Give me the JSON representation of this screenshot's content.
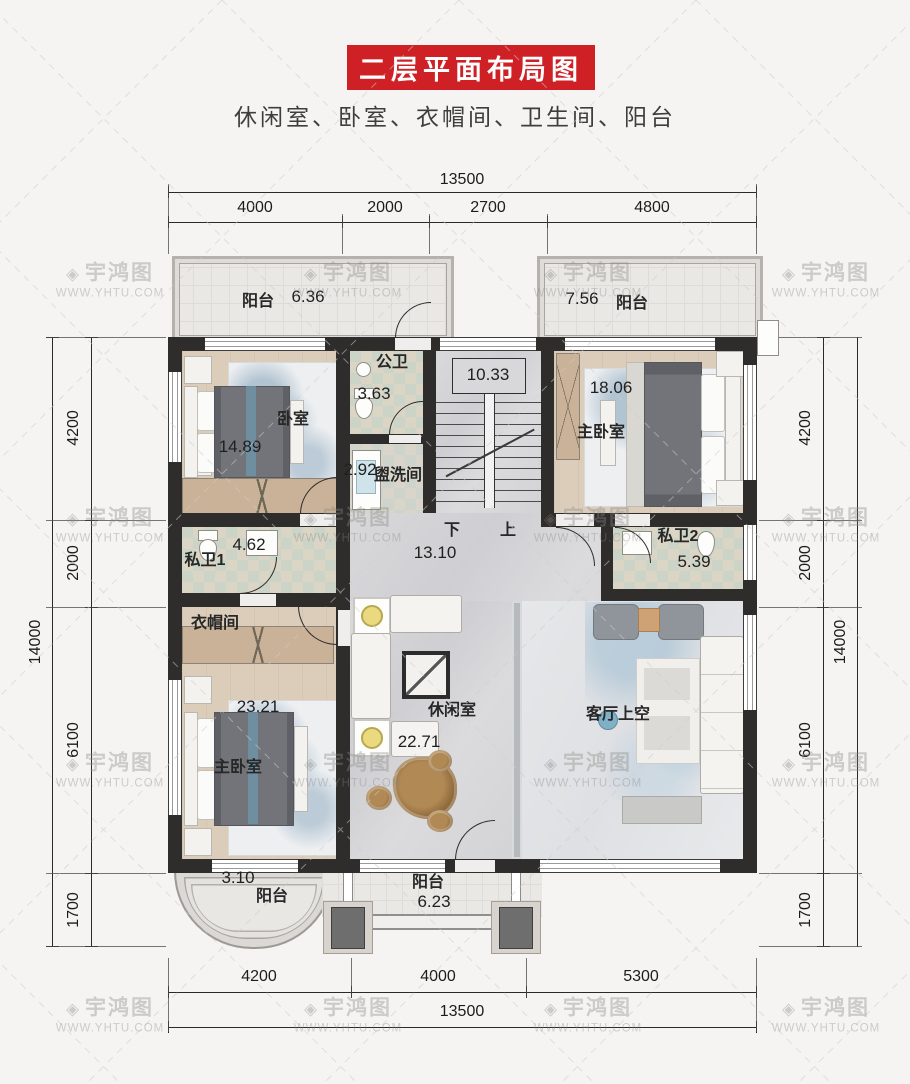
{
  "header": {
    "title": "二层平面布局图",
    "subtitle": "休闲室、卧室、衣帽间、卫生间、阳台",
    "banner_color": "#ce2025"
  },
  "watermark": {
    "logo": "◈",
    "brand": "宇鸿图",
    "url": "WWW.YHTU.COM"
  },
  "dimensions": {
    "top": {
      "total": "13500",
      "segments": [
        "4000",
        "2000",
        "2700",
        "4800"
      ]
    },
    "bottom": {
      "total": "13500",
      "segments": [
        "4200",
        "4000",
        "5300"
      ]
    },
    "left": {
      "total": "14000",
      "segments": [
        "4200",
        "2000",
        "6100",
        "1700"
      ]
    },
    "right": {
      "total": "14000",
      "segments": [
        "4200",
        "2000",
        "6100",
        "1700"
      ]
    }
  },
  "rooms": {
    "balcony_tl": {
      "name": "阳台",
      "area": "6.36"
    },
    "balcony_tr": {
      "name": "阳台",
      "area": "7.56"
    },
    "bedroom": {
      "name": "卧室",
      "area": "14.89"
    },
    "public_bath": {
      "name": "公卫",
      "area": "3.63"
    },
    "washroom": {
      "name": "盥洗间",
      "area": "2.92"
    },
    "stairs": {
      "area": "10.33",
      "down": "下",
      "up": "上"
    },
    "master_tr": {
      "name": "主卧室",
      "area": "18.06"
    },
    "private_bath1": {
      "name": "私卫1",
      "area": "4.62"
    },
    "hall": {
      "area": "13.10"
    },
    "private_bath2": {
      "name": "私卫2",
      "area": "5.39"
    },
    "cloakroom": {
      "name": "衣帽间"
    },
    "master_bl": {
      "name": "主卧室",
      "area": "23.21"
    },
    "leisure": {
      "name": "休闲室",
      "area": "22.71"
    },
    "living_void": {
      "name": "客厅上空"
    },
    "balcony_bl": {
      "name": "阳台",
      "area": "3.10"
    },
    "balcony_bc": {
      "name": "阳台",
      "area": "6.23"
    }
  }
}
